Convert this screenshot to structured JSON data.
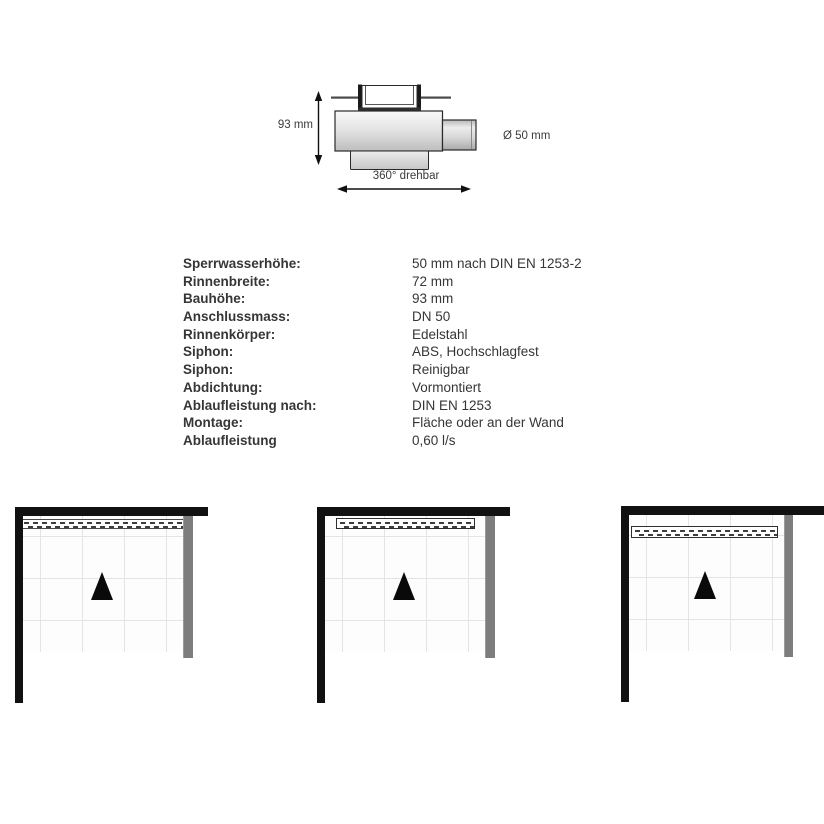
{
  "drawing": {
    "height_label": "93 mm",
    "diameter_label": "Ø 50 mm",
    "rotation_label": "360° drehbar"
  },
  "specs": {
    "rows": [
      {
        "label": "Sperrwasserhöhe:",
        "value": "50 mm nach DIN EN 1253-2"
      },
      {
        "label": "Rinnenbreite:",
        "value": "72 mm"
      },
      {
        "label": "Bauhöhe:",
        "value": "93 mm"
      },
      {
        "label": "Anschlussmass:",
        "value": "DN 50"
      },
      {
        "label": "Rinnenkörper:",
        "value": "Edelstahl"
      },
      {
        "label": "Siphon:",
        "value": "ABS, Hochschlagfest"
      },
      {
        "label": "Siphon:",
        "value": "Reinigbar"
      },
      {
        "label": "Abdichtung:",
        "value": "Vormontiert"
      },
      {
        "label": "Ablaufleistung nach:",
        "value": "DIN EN 1253"
      },
      {
        "label": "Montage:",
        "value": "Fläche oder an der Wand"
      },
      {
        "label": "Ablaufleistung",
        "value": "0,60 l/s"
      }
    ]
  },
  "diagrams": {
    "count": 3,
    "colors": {
      "wall": "#111111",
      "glass_panel": "#7d7d7d",
      "slope_marker": "#0a0a0a",
      "tile_grid": "#e4e4e4"
    }
  }
}
